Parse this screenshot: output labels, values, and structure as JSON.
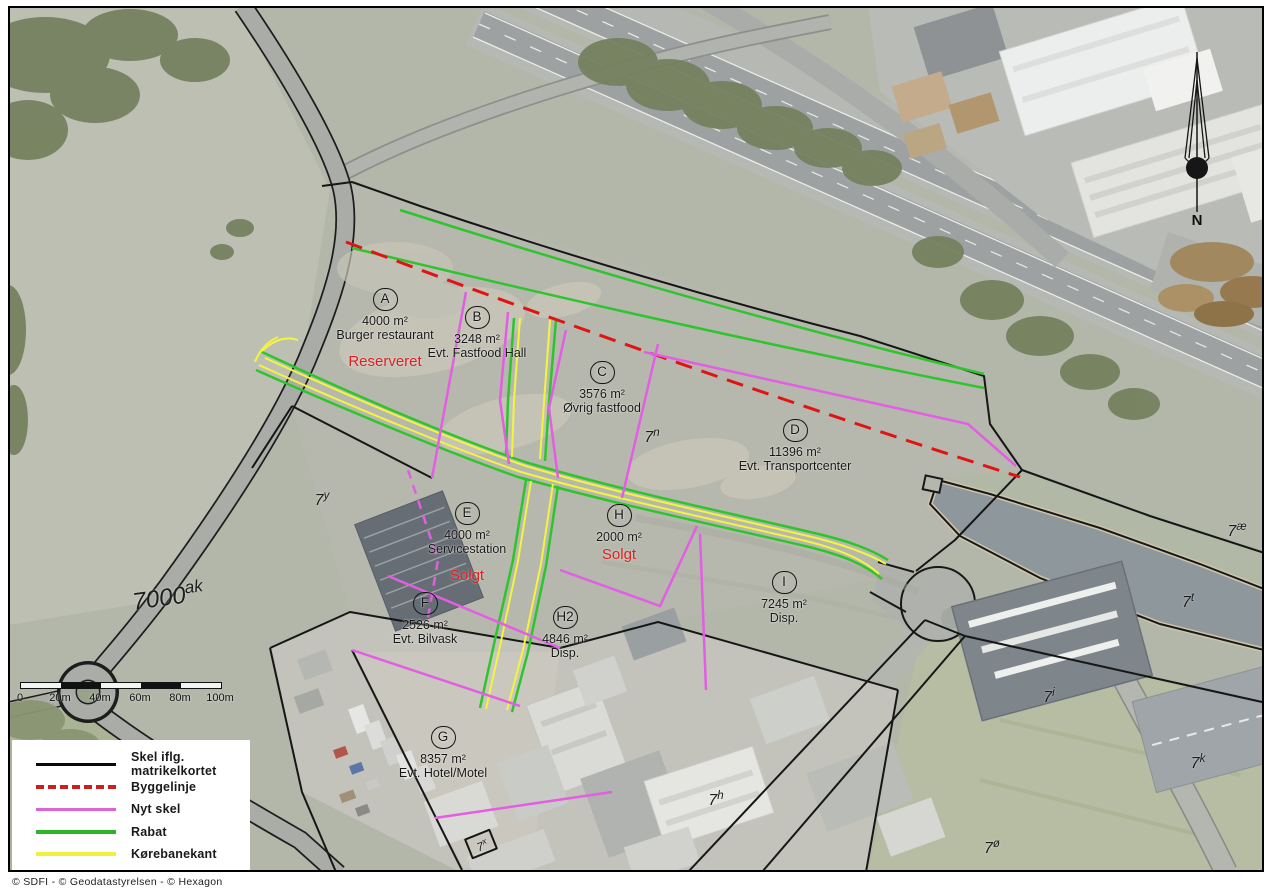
{
  "parcels": [
    {
      "letter": "A",
      "area": "4000 m²",
      "use": "Burger restaurant",
      "status": "Reserveret"
    },
    {
      "letter": "B",
      "area": "3248 m²",
      "use": "Evt. Fastfood Hall"
    },
    {
      "letter": "C",
      "area": "3576 m²",
      "use": "Øvrig fastfood"
    },
    {
      "letter": "D",
      "area": "11396 m²",
      "use": "Evt. Transportcenter"
    },
    {
      "letter": "E",
      "area": "4000 m²",
      "use": "Servicestation",
      "status": "Solgt"
    },
    {
      "letter": "F",
      "area": "2526 m²",
      "use": "Evt. Bilvask"
    },
    {
      "letter": "G",
      "area": "8357 m²",
      "use": "Evt. Hotel/Motel"
    },
    {
      "letter": "H",
      "area": "2000 m²",
      "status": "Solgt"
    },
    {
      "letter": "H2",
      "area": "4846 m²",
      "use": "Disp."
    },
    {
      "letter": "I",
      "area": "7245 m²",
      "use": "Disp."
    }
  ],
  "cadastre": {
    "labels": [
      {
        "base": "7000",
        "sup": "ak"
      },
      {
        "base": "7",
        "sup": "y"
      },
      {
        "base": "7",
        "sup": "n"
      },
      {
        "base": "7",
        "sup": "æ"
      },
      {
        "base": "7",
        "sup": "t"
      },
      {
        "base": "7",
        "sup": "i"
      },
      {
        "base": "7",
        "sup": "k"
      },
      {
        "base": "7",
        "sup": "h"
      },
      {
        "base": "7",
        "sup": "ø"
      },
      {
        "base": "7",
        "sup": "x"
      }
    ]
  },
  "legend": {
    "items": [
      {
        "label": "Skel iflg. matrikelkortet",
        "color": "#000000",
        "style": "solid"
      },
      {
        "label": "Byggelinje",
        "color": "#cc1f1f",
        "style": "dashed"
      },
      {
        "label": "Nyt skel",
        "color": "#d966d9",
        "style": "solid"
      },
      {
        "label": "Rabat",
        "color": "#2bb52b",
        "style": "solid"
      },
      {
        "label": "Kørebanekant",
        "color": "#f1f13c",
        "style": "solid"
      }
    ]
  },
  "map_colors": {
    "skel": "#161616",
    "byggelinje": "#e01414",
    "nyt_skel": "#e25ee2",
    "rabat": "#2dc42d",
    "korebanekant": "#f4f440",
    "status_text": "#e01f1f"
  },
  "scale_bar": {
    "tick_labels": [
      "0",
      "20m",
      "40m",
      "60m",
      "80m",
      "100m"
    ]
  },
  "compass": {
    "label": "N"
  },
  "footer": {
    "copyright": "© SDFI -  © Geodatastyrelsen -  © Hexagon"
  }
}
